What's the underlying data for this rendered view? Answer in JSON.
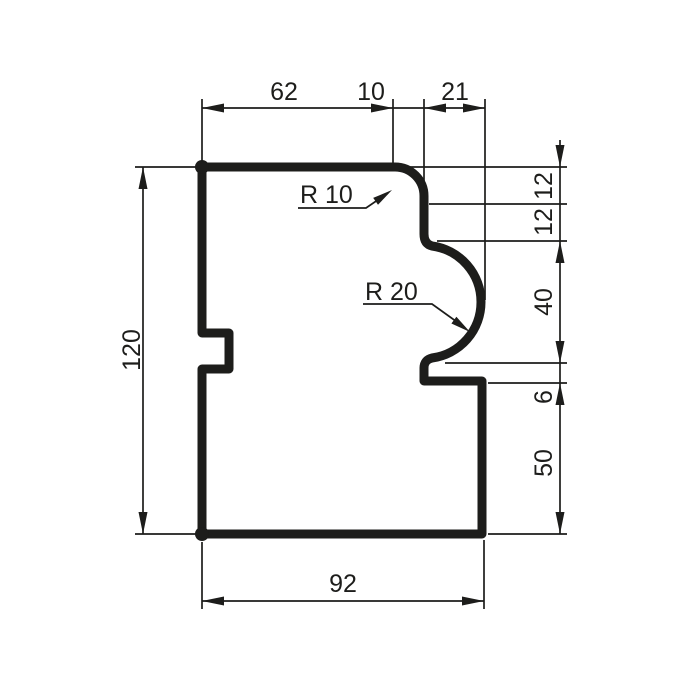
{
  "drawing": {
    "type": "technical-profile-cross-section",
    "background_color": "#ffffff",
    "line_color": "#1d1d1b",
    "dims": {
      "top": [
        {
          "label": "62"
        },
        {
          "label": "10"
        },
        {
          "label": "21"
        }
      ],
      "right": [
        {
          "label": "12"
        },
        {
          "label": "12"
        },
        {
          "label": "40"
        },
        {
          "label": "6"
        },
        {
          "label": "50"
        }
      ],
      "left": [
        {
          "label": "120"
        }
      ],
      "bottom": [
        {
          "label": "92"
        }
      ],
      "radii": [
        {
          "label": "R 10"
        },
        {
          "label": "R 20"
        }
      ]
    }
  }
}
